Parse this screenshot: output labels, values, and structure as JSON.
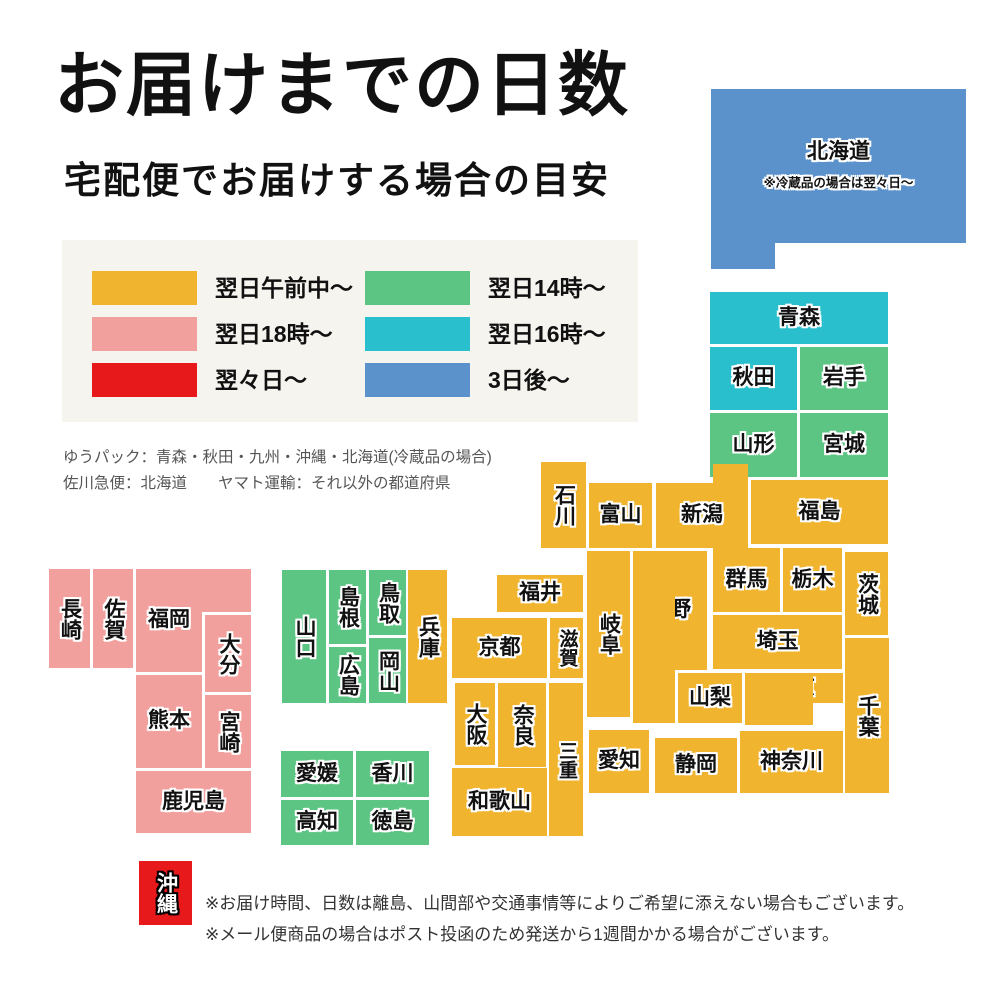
{
  "page": {
    "title": "お届けまでの日数",
    "subtitle": "宅配便でお届けする場合の目安"
  },
  "colors": {
    "yellow": "#F0B42F",
    "pink": "#F2A09E",
    "red": "#E8191B",
    "green": "#5CC583",
    "teal": "#29BFCD",
    "blue": "#5B92CB",
    "legend_bg": "#F6F4EF"
  },
  "legend": {
    "items": [
      {
        "label": "翌日午前中〜",
        "color": "yellow"
      },
      {
        "label": "翌日18時〜",
        "color": "pink"
      },
      {
        "label": "翌々日〜",
        "color": "red"
      },
      {
        "label": "翌日14時〜",
        "color": "green"
      },
      {
        "label": "翌日16時〜",
        "color": "teal"
      },
      {
        "label": "3日後〜",
        "color": "blue"
      }
    ]
  },
  "carrier_notes": [
    "ゆうパック：青森・秋田・九州・沖縄・北海道(冷蔵品の場合)",
    "佐川急便：北海道　　ヤマト運輸：それ以外の都道府県"
  ],
  "map": {
    "prefectures": [
      {
        "name": "北海道",
        "color": "blue",
        "rects": [
          [
            711,
            89,
            255,
            154
          ],
          [
            711,
            241,
            64,
            28
          ]
        ],
        "label_rect": 0,
        "note": "※冷蔵品の場合は翌々日〜"
      },
      {
        "name": "青森",
        "color": "teal",
        "rects": [
          [
            710,
            292,
            178,
            52
          ]
        ]
      },
      {
        "name": "秋田",
        "color": "teal",
        "rects": [
          [
            710,
            347,
            87,
            63
          ]
        ]
      },
      {
        "name": "岩手",
        "color": "green",
        "rects": [
          [
            800,
            347,
            88,
            63
          ]
        ]
      },
      {
        "name": "山形",
        "color": "green",
        "rects": [
          [
            710,
            413,
            87,
            64
          ]
        ]
      },
      {
        "name": "宮城",
        "color": "green",
        "rects": [
          [
            800,
            413,
            88,
            64
          ]
        ]
      },
      {
        "name": "新潟",
        "color": "yellow",
        "rects": [
          [
            656,
            483,
            92,
            65
          ],
          [
            713,
            464,
            35,
            21
          ]
        ],
        "label_rect": 0
      },
      {
        "name": "富山",
        "color": "yellow",
        "rects": [
          [
            589,
            483,
            63,
            65
          ]
        ]
      },
      {
        "name": "石川",
        "color": "yellow",
        "vertical": true,
        "rects": [
          [
            541,
            462,
            45,
            86
          ]
        ]
      },
      {
        "name": "福井",
        "color": "yellow",
        "rects": [
          [
            497,
            575,
            86,
            37
          ]
        ]
      },
      {
        "name": "福島",
        "color": "yellow",
        "rects": [
          [
            751,
            480,
            137,
            64
          ]
        ]
      },
      {
        "name": "群馬",
        "color": "yellow",
        "rects": [
          [
            713,
            548,
            67,
            64
          ]
        ]
      },
      {
        "name": "栃木",
        "color": "yellow",
        "rects": [
          [
            783,
            548,
            59,
            64
          ]
        ]
      },
      {
        "name": "茨城",
        "color": "yellow",
        "vertical": true,
        "rects": [
          [
            845,
            552,
            43,
            83
          ]
        ]
      },
      {
        "name": "埼玉",
        "color": "yellow",
        "rects": [
          [
            713,
            615,
            129,
            54
          ]
        ]
      },
      {
        "name": "長野",
        "color": "yellow",
        "rects": [
          [
            633,
            551,
            74,
            119
          ],
          [
            633,
            551,
            42,
            172
          ]
        ],
        "label_rect": 0
      },
      {
        "name": "岐阜",
        "color": "yellow",
        "vertical": true,
        "rects": [
          [
            587,
            551,
            43,
            166
          ]
        ]
      },
      {
        "name": "山梨",
        "color": "yellow",
        "rects": [
          [
            678,
            673,
            64,
            50
          ]
        ]
      },
      {
        "name": "東京",
        "color": "yellow",
        "rects": [
          [
            745,
            673,
            98,
            30
          ],
          [
            745,
            673,
            68,
            52
          ]
        ],
        "label_rect": 0
      },
      {
        "name": "千葉",
        "color": "yellow",
        "vertical": true,
        "rects": [
          [
            845,
            638,
            44,
            155
          ]
        ]
      },
      {
        "name": "神奈川",
        "color": "yellow",
        "rects": [
          [
            740,
            731,
            103,
            62
          ]
        ]
      },
      {
        "name": "静岡",
        "color": "yellow",
        "rects": [
          [
            655,
            738,
            82,
            55
          ]
        ]
      },
      {
        "name": "愛知",
        "color": "yellow",
        "rects": [
          [
            589,
            730,
            60,
            63
          ]
        ]
      },
      {
        "name": "滋賀",
        "color": "yellow",
        "vertical": true,
        "small": true,
        "rects": [
          [
            550,
            618,
            33,
            60
          ]
        ]
      },
      {
        "name": "京都",
        "color": "yellow",
        "rects": [
          [
            452,
            618,
            95,
            60
          ]
        ]
      },
      {
        "name": "大阪",
        "color": "yellow",
        "vertical": true,
        "rects": [
          [
            455,
            683,
            40,
            82
          ]
        ]
      },
      {
        "name": "奈良",
        "color": "yellow",
        "vertical": true,
        "rects": [
          [
            498,
            683,
            48,
            84
          ]
        ]
      },
      {
        "name": "三重",
        "color": "yellow",
        "vertical": true,
        "small": true,
        "rects": [
          [
            549,
            683,
            34,
            153
          ]
        ]
      },
      {
        "name": "和歌山",
        "color": "yellow",
        "rects": [
          [
            452,
            768,
            95,
            68
          ]
        ]
      },
      {
        "name": "兵庫",
        "color": "yellow",
        "vertical": true,
        "rects": [
          [
            408,
            570,
            39,
            133
          ]
        ]
      },
      {
        "name": "鳥取",
        "color": "green",
        "vertical": true,
        "rects": [
          [
            369,
            570,
            37,
            65
          ]
        ]
      },
      {
        "name": "島根",
        "color": "green",
        "vertical": true,
        "rects": [
          [
            329,
            570,
            37,
            74
          ]
        ]
      },
      {
        "name": "岡山",
        "color": "green",
        "vertical": true,
        "rects": [
          [
            369,
            638,
            37,
            65
          ]
        ]
      },
      {
        "name": "広島",
        "color": "green",
        "vertical": true,
        "rects": [
          [
            329,
            647,
            37,
            56
          ]
        ]
      },
      {
        "name": "山口",
        "color": "green",
        "vertical": true,
        "rects": [
          [
            282,
            570,
            44,
            133
          ]
        ]
      },
      {
        "name": "愛媛",
        "color": "green",
        "rects": [
          [
            281,
            751,
            72,
            46
          ]
        ]
      },
      {
        "name": "香川",
        "color": "green",
        "rects": [
          [
            356,
            751,
            73,
            46
          ]
        ]
      },
      {
        "name": "高知",
        "color": "green",
        "rects": [
          [
            281,
            800,
            72,
            45
          ]
        ]
      },
      {
        "name": "徳島",
        "color": "green",
        "rects": [
          [
            356,
            800,
            73,
            45
          ]
        ]
      },
      {
        "name": "福岡",
        "color": "pink",
        "rects": [
          [
            136,
            569,
            115,
            43
          ],
          [
            136,
            569,
            66,
            103
          ]
        ],
        "label_rect": 1
      },
      {
        "name": "佐賀",
        "color": "pink",
        "vertical": true,
        "rects": [
          [
            93,
            569,
            40,
            99
          ]
        ]
      },
      {
        "name": "長崎",
        "color": "pink",
        "vertical": true,
        "rects": [
          [
            49,
            569,
            41,
            99
          ]
        ]
      },
      {
        "name": "大分",
        "color": "pink",
        "vertical": true,
        "rects": [
          [
            205,
            615,
            46,
            77
          ]
        ]
      },
      {
        "name": "熊本",
        "color": "pink",
        "rects": [
          [
            136,
            675,
            66,
            93
          ]
        ]
      },
      {
        "name": "宮崎",
        "color": "pink",
        "vertical": true,
        "rects": [
          [
            205,
            695,
            46,
            73
          ]
        ]
      },
      {
        "name": "鹿児島",
        "color": "pink",
        "rects": [
          [
            136,
            771,
            115,
            62
          ]
        ]
      },
      {
        "name": "沖縄",
        "color": "red",
        "vertical": true,
        "text": "white",
        "rects": [
          [
            139,
            861,
            53,
            64
          ]
        ]
      }
    ]
  },
  "footer_notes": [
    "※お届け時間、日数は離島、山間部や交通事情等によりご希望に添えない場合もございます。",
    "※メール便商品の場合はポスト投函のため発送から1週間かかる場合がございます。"
  ]
}
